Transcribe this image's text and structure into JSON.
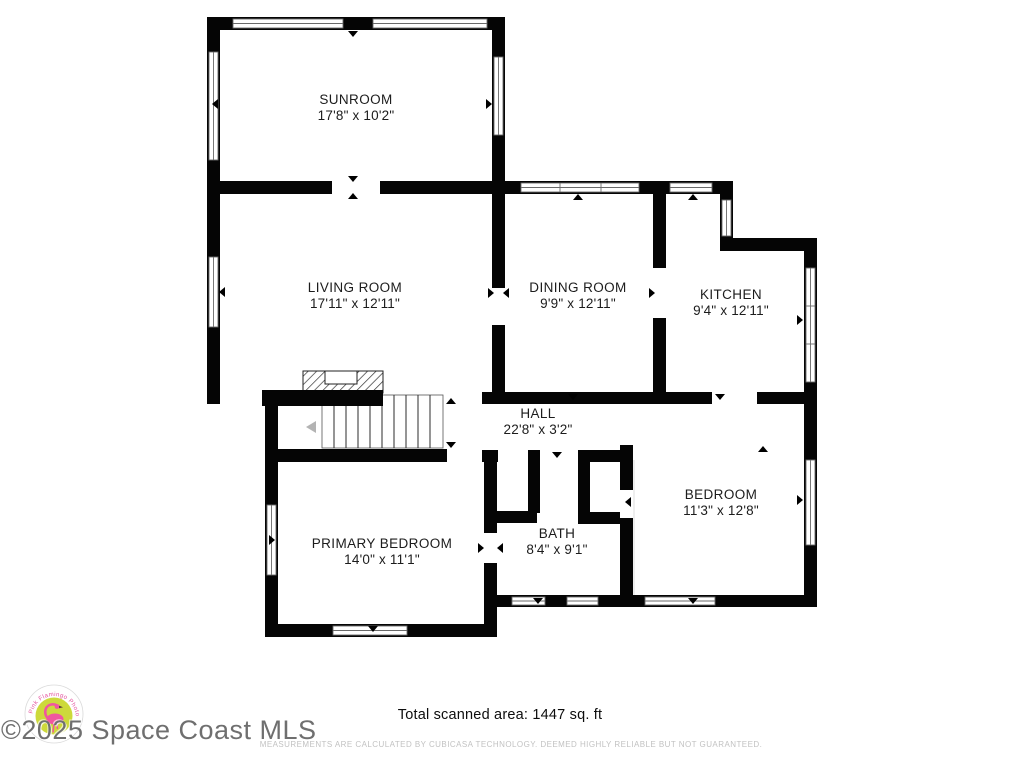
{
  "plan": {
    "rooms": [
      {
        "id": "sunroom",
        "name": "SUNROOM",
        "dims": "17'8\" x 10'2\""
      },
      {
        "id": "living-room",
        "name": "LIVING ROOM",
        "dims": "17'11\" x 12'11\""
      },
      {
        "id": "dining-room",
        "name": "DINING ROOM",
        "dims": "9'9\" x 12'11\""
      },
      {
        "id": "kitchen",
        "name": "KITCHEN",
        "dims": "9'4\" x 12'11\""
      },
      {
        "id": "hall",
        "name": "HALL",
        "dims": "22'8\" x 3'2\""
      },
      {
        "id": "bedroom",
        "name": "BEDROOM",
        "dims": "11'3\" x 12'8\""
      },
      {
        "id": "bath",
        "name": "BATH",
        "dims": "8'4\" x 9'1\""
      },
      {
        "id": "primary-bedroom",
        "name": "PRIMARY BEDROOM",
        "dims": "14'0\" x 11'1\""
      }
    ],
    "footer": {
      "total_area": "Total scanned area: 1447 sq. ft",
      "disclaimer": "MEASUREMENTS ARE CALCULATED BY CUBICASA TECHNOLOGY. DEEMED HIGHLY RELIABLE BUT NOT GUARANTEED."
    },
    "watermark": "©2025 Space Coast MLS",
    "logo": {
      "arc_text": "Pink Flamingo Photography"
    },
    "colors": {
      "wall": "#000000",
      "background": "#ffffff",
      "label": "#1c1c1c",
      "disclaimer": "#c2c2c2",
      "watermark": "#6f6f6f",
      "logo_pink": "#e4509d",
      "logo_green": "#cdd93b"
    }
  }
}
